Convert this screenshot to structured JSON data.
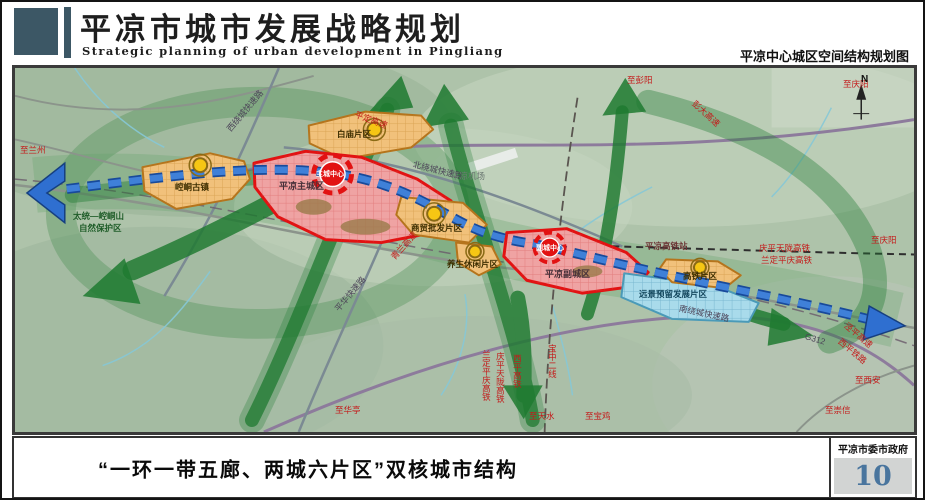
{
  "header": {
    "title_cn": "平凉市城市发展战略规划",
    "title_en": "Strategic planning of urban development in Pingliang",
    "map_title": "平凉中心城区空间结构规划图"
  },
  "map": {
    "compass": "N",
    "labels": [
      {
        "text": "至兰州"
      },
      {
        "text": "西绕城快速路"
      },
      {
        "text": "平定高速"
      },
      {
        "text": "北绕城快速路"
      },
      {
        "text": "白庙片区"
      },
      {
        "text": "至彭阳"
      },
      {
        "text": "彭大高速"
      },
      {
        "text": "至庆阳"
      },
      {
        "text": "平凉机场"
      },
      {
        "text": "太统—崆峒山"
      },
      {
        "text": "自然保护区"
      },
      {
        "text": "崆峒古镇"
      },
      {
        "text": "平凉主城区"
      },
      {
        "text": "主城中心"
      },
      {
        "text": "商贸批发片区"
      },
      {
        "text": "养生休闲片区"
      },
      {
        "text": "青兰高速"
      },
      {
        "text": "平凉副城区"
      },
      {
        "text": "副城中心"
      },
      {
        "text": "平凉高铁站"
      },
      {
        "text": "庆平天陇高铁"
      },
      {
        "text": "兰定平庆高铁"
      },
      {
        "text": "至庆阳"
      },
      {
        "text": "高铁片区"
      },
      {
        "text": "远景预留发展片区"
      },
      {
        "text": "南绕城快速路"
      },
      {
        "text": "G312"
      },
      {
        "text": "泾平高速"
      },
      {
        "text": "西平铁路"
      },
      {
        "text": "至西安"
      },
      {
        "text": "至崇信"
      },
      {
        "text": "至华亭"
      },
      {
        "text": "平华快速路"
      },
      {
        "text": "兰定平庆高铁"
      },
      {
        "text": "庆平天陇高铁"
      },
      {
        "text": "西平高铁"
      },
      {
        "text": "宝中二线"
      },
      {
        "text": "至天水"
      },
      {
        "text": "至宝鸡"
      }
    ]
  },
  "footer": {
    "caption": "“一环一带五廊、两城六片区”双核城市结构",
    "agency": "平凉市委市政府",
    "page_number": "10"
  },
  "colors": {
    "header_accent": "#3c5765",
    "corridor_green": "#1e7a30",
    "axis_blue": "#2f6fd0",
    "zone_orange_fill": "#f1c17b",
    "zone_orange_border": "#b5741c",
    "zone_red_fill": "#efa3a3",
    "zone_red_border": "#e21212",
    "zone_blue_fill": "#a9dbeb",
    "node_yellow": "#f6c614",
    "label_red": "#c41a1a",
    "page_number_blue": "#49759e"
  }
}
